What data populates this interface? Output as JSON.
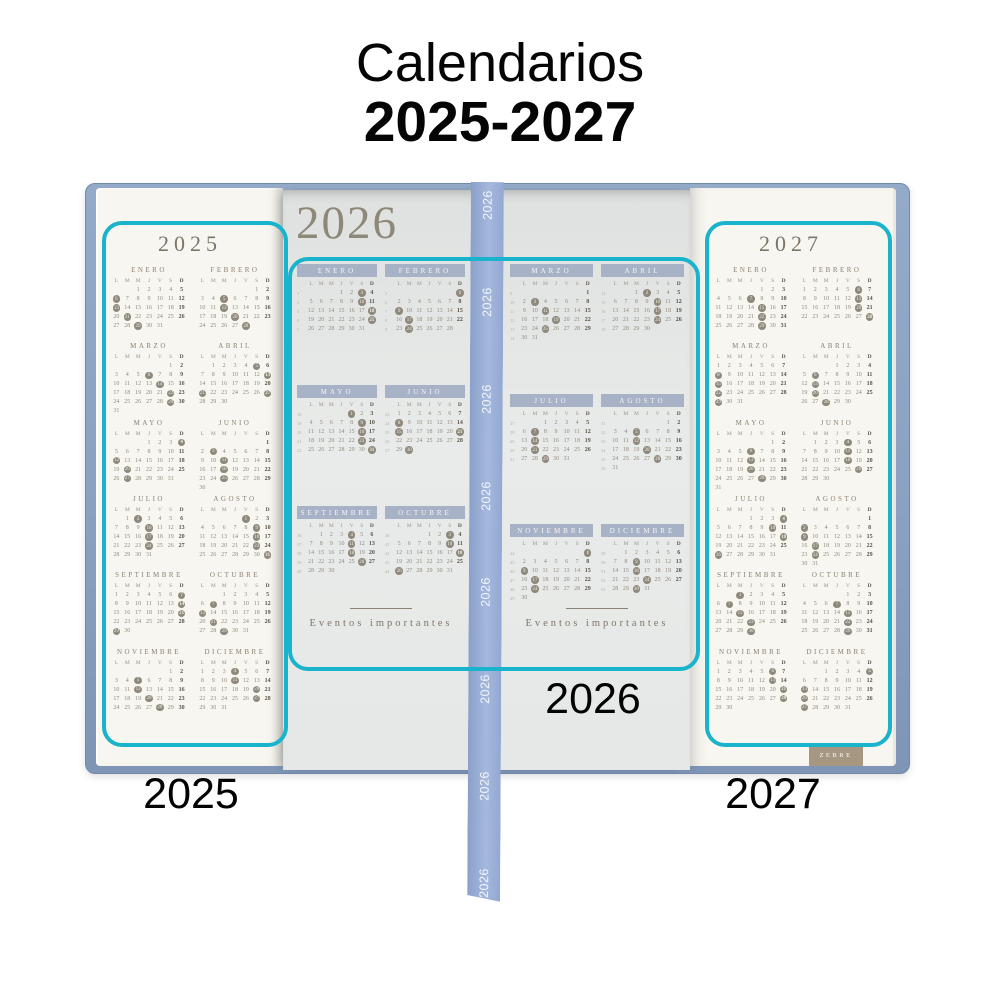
{
  "title": {
    "line1": "Calendarios",
    "line2": "2025-2027"
  },
  "annotations": {
    "left_label": "2025",
    "center_label": "2026",
    "right_label": "2027"
  },
  "brand_stamp": "ZEBRE",
  "ribbon": {
    "text": "2026",
    "repeat": 8
  },
  "colors": {
    "highlight_box": "#19b3cb",
    "cover_blue": "#8ba1c1",
    "ribbon_blue": "#9bb0d8",
    "page_cream": "#f8f6f0",
    "center_page_gray": "#e6e8e7",
    "month_banner": "#a8b2c6",
    "ink_taupe": "#8a8172"
  },
  "calendar": {
    "day_headers": [
      "L",
      "M",
      "M",
      "J",
      "V",
      "S",
      "D"
    ],
    "events_label": "Eventos importantes",
    "years": {
      "y2025": {
        "label": "2025",
        "months": [
          {
            "name": "ENERO",
            "offset": 2,
            "days": 31,
            "marks": [
              6,
              13,
              21,
              29
            ]
          },
          {
            "name": "FEBRERO",
            "offset": 5,
            "days": 28,
            "marks": [
              5,
              12,
              20,
              28
            ]
          },
          {
            "name": "MARZO",
            "offset": 5,
            "days": 31,
            "marks": [
              6,
              14,
              22,
              29
            ]
          },
          {
            "name": "ABRIL",
            "offset": 1,
            "days": 30,
            "marks": [
              5,
              13,
              21,
              27
            ]
          },
          {
            "name": "MAYO",
            "offset": 3,
            "days": 31,
            "marks": [
              4,
              12,
              20,
              27
            ]
          },
          {
            "name": "JUNIO",
            "offset": 6,
            "days": 30,
            "marks": [
              3,
              11,
              18,
              25
            ]
          },
          {
            "name": "JULIO",
            "offset": 1,
            "days": 31,
            "marks": [
              2,
              10,
              17,
              24
            ]
          },
          {
            "name": "AGOSTO",
            "offset": 4,
            "days": 31,
            "marks": [
              1,
              9,
              16,
              23,
              31
            ]
          },
          {
            "name": "SEPTIEMBRE",
            "offset": 0,
            "days": 30,
            "marks": [
              7,
              14,
              21,
              29
            ]
          },
          {
            "name": "OCTUBRE",
            "offset": 2,
            "days": 31,
            "marks": [
              7,
              13,
              21,
              29
            ]
          },
          {
            "name": "NOVIEMBRE",
            "offset": 5,
            "days": 30,
            "marks": [
              5,
              12,
              20,
              28
            ]
          },
          {
            "name": "DICIEMBRE",
            "offset": 0,
            "days": 31,
            "marks": [
              4,
              11,
              20,
              27
            ]
          }
        ]
      },
      "y2026": {
        "label": "2026",
        "months": [
          {
            "name": "ENERO",
            "offset": 3,
            "days": 31,
            "week_start": 1,
            "marks": [
              3,
              10,
              18,
              25
            ]
          },
          {
            "name": "FEBRERO",
            "offset": 6,
            "days": 28,
            "week_start": 5,
            "marks": [
              1,
              9,
              17,
              24
            ]
          },
          {
            "name": "MARZO",
            "offset": 6,
            "days": 31,
            "week_start": 9,
            "marks": [
              3,
              11,
              19,
              25
            ]
          },
          {
            "name": "ABRIL",
            "offset": 2,
            "days": 30,
            "week_start": 14,
            "marks": [
              2,
              10,
              17,
              24
            ]
          },
          {
            "name": "MAYO",
            "offset": 4,
            "days": 31,
            "week_start": 18,
            "marks": [
              1,
              9,
              16,
              23,
              31
            ]
          },
          {
            "name": "JUNIO",
            "offset": 0,
            "days": 30,
            "week_start": 23,
            "marks": [
              8,
              15,
              21,
              30
            ]
          },
          {
            "name": "JULIO",
            "offset": 2,
            "days": 31,
            "week_start": 27,
            "marks": [
              7,
              14,
              21,
              29
            ]
          },
          {
            "name": "AGOSTO",
            "offset": 5,
            "days": 31,
            "week_start": 31,
            "marks": [
              5,
              12,
              20,
              28
            ]
          },
          {
            "name": "SEPTIEMBRE",
            "offset": 1,
            "days": 30,
            "week_start": 36,
            "marks": [
              4,
              11,
              18,
              26
            ]
          },
          {
            "name": "OCTUBRE",
            "offset": 3,
            "days": 31,
            "week_start": 40,
            "marks": [
              3,
              10,
              18,
              26
            ]
          },
          {
            "name": "NOVIEMBRE",
            "offset": 6,
            "days": 30,
            "week_start": 44,
            "marks": [
              1,
              9,
              17,
              24
            ]
          },
          {
            "name": "DICIEMBRE",
            "offset": 1,
            "days": 31,
            "week_start": 49,
            "marks": [
              9,
              16,
              24,
              30
            ]
          }
        ]
      },
      "y2027": {
        "label": "2027",
        "months": [
          {
            "name": "ENERO",
            "offset": 4,
            "days": 31,
            "marks": [
              7,
              15,
              22,
              29
            ]
          },
          {
            "name": "FEBRERO",
            "offset": 0,
            "days": 28,
            "marks": [
              6,
              13,
              20,
              28
            ]
          },
          {
            "name": "MARZO",
            "offset": 0,
            "days": 31,
            "marks": [
              8,
              15,
              22,
              29
            ]
          },
          {
            "name": "ABRIL",
            "offset": 3,
            "days": 30,
            "marks": [
              6,
              13,
              20,
              28
            ]
          },
          {
            "name": "MAYO",
            "offset": 5,
            "days": 31,
            "marks": [
              6,
              13,
              20,
              28
            ]
          },
          {
            "name": "JUNIO",
            "offset": 1,
            "days": 30,
            "marks": [
              4,
              11,
              18,
              26
            ]
          },
          {
            "name": "JULIO",
            "offset": 3,
            "days": 31,
            "marks": [
              4,
              10,
              18,
              26
            ]
          },
          {
            "name": "AGOSTO",
            "offset": 6,
            "days": 31,
            "marks": [
              2,
              9,
              17,
              24
            ]
          },
          {
            "name": "SEPTIEMBRE",
            "offset": 2,
            "days": 30,
            "marks": [
              1,
              7,
              15,
              23,
              30
            ]
          },
          {
            "name": "OCTUBRE",
            "offset": 4,
            "days": 31,
            "marks": [
              7,
              15,
              22,
              29
            ]
          },
          {
            "name": "NOVIEMBRE",
            "offset": 0,
            "days": 30,
            "marks": [
              6,
              13,
              21,
              28
            ]
          },
          {
            "name": "DICIEMBRE",
            "offset": 2,
            "days": 31,
            "marks": [
              5,
              13,
              20,
              27
            ]
          }
        ]
      }
    }
  }
}
